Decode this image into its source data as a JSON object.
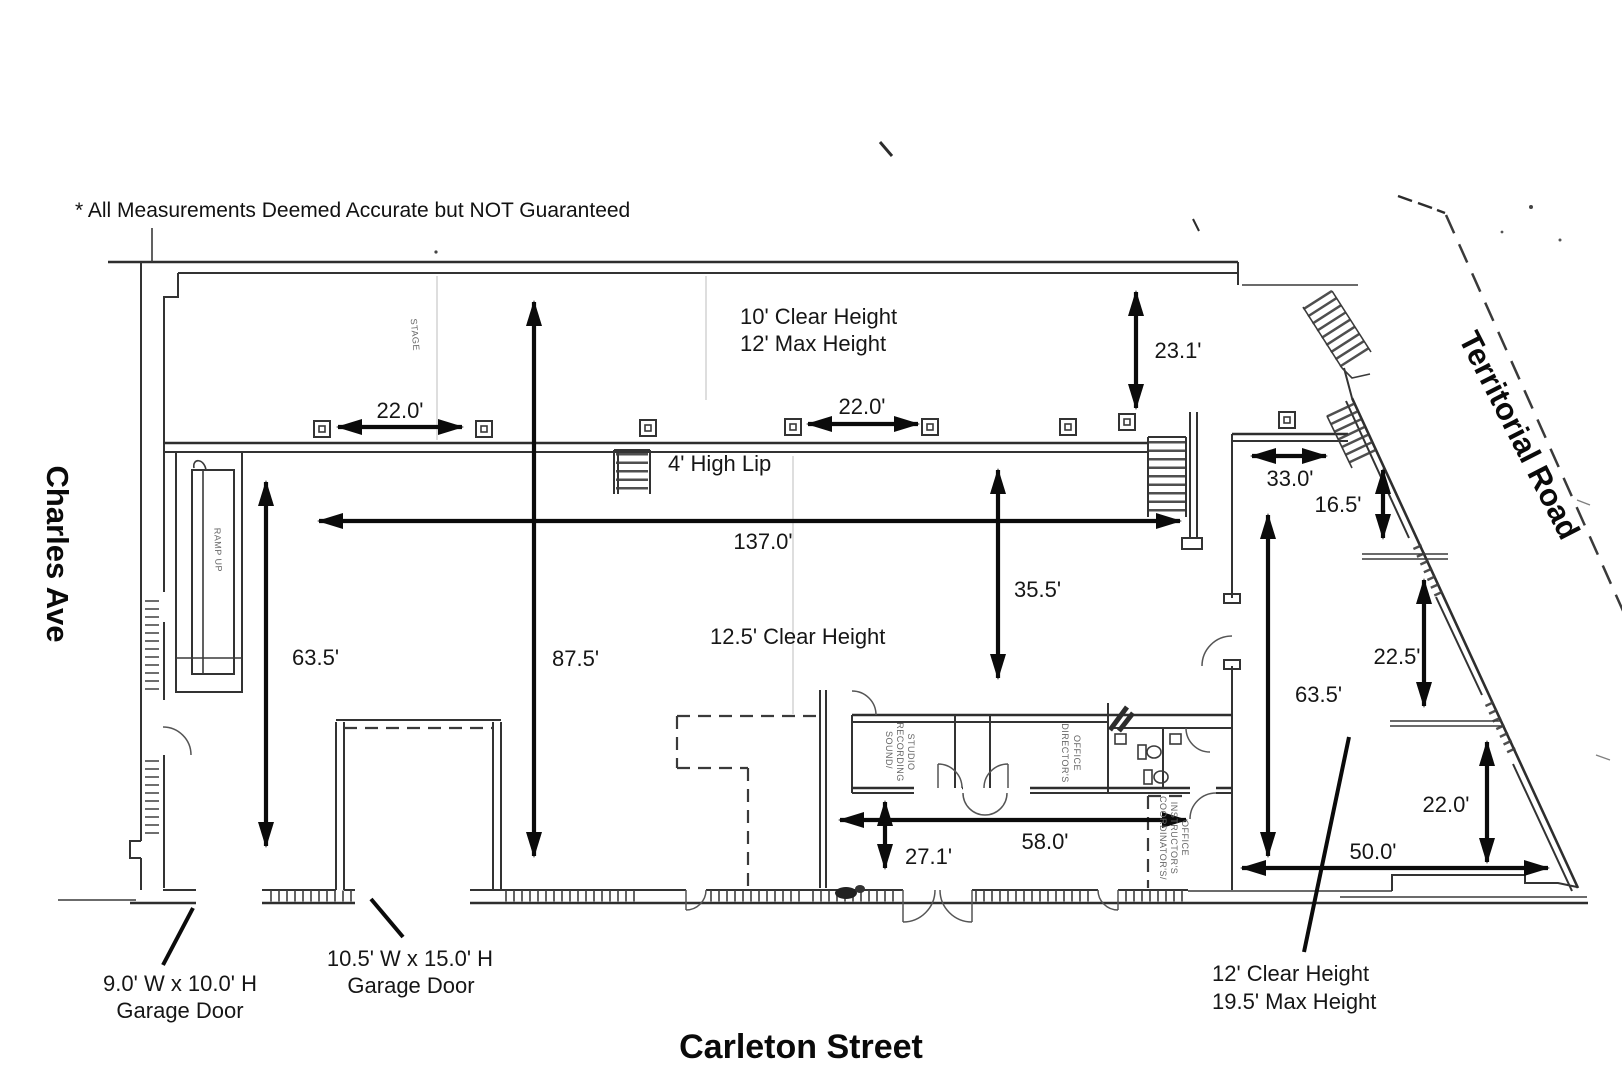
{
  "disclaimer": "*  All Measurements Deemed Accurate but NOT Guaranteed",
  "streets": {
    "left": "Charles Ave",
    "bottom": "Carleton Street",
    "right": "Territorial Road"
  },
  "heights": {
    "stage_line1": "10' Clear Height",
    "stage_line2": "12' Max Height",
    "lip": "4' High Lip",
    "main": "12.5' Clear Height",
    "right_line1": "12' Clear Height",
    "right_line2": "19.5' Max Height"
  },
  "garage_doors": {
    "small_size": "9.0' W x  10.0' H",
    "small_label": "Garage Door",
    "large_size": "10.5' W x  15.0' H",
    "large_label": "Garage Door"
  },
  "dimensions": {
    "bay_spacing_a": "22.0'",
    "bay_spacing_b": "22.0'",
    "stage_depth": "23.1'",
    "hall_length": "137.0'",
    "hall_depth": "63.5'",
    "overall_depth": "87.5'",
    "mid_depth": "35.5'",
    "office_width": "58.0'",
    "office_depth": "27.1'",
    "right_top_width": "33.0'",
    "right_nook_depth": "16.5'",
    "right_depth": "63.5'",
    "right_mid_depth": "22.5'",
    "right_lower_depth": "22.0'",
    "right_width": "50.0'"
  },
  "rooms": {
    "stage": "STAGE",
    "ramp": "RAMP UP",
    "studio_line1": "SOUND/",
    "studio_line2": "RECORDING",
    "studio_line3": "STUDIO",
    "director_line1": "DIRECTOR'S",
    "director_line2": "OFFICE",
    "coordinator_line1": "COORDINATOR'S/",
    "coordinator_line2": "INSTRUCTOR'S",
    "coordinator_line3": "OFFICE"
  }
}
